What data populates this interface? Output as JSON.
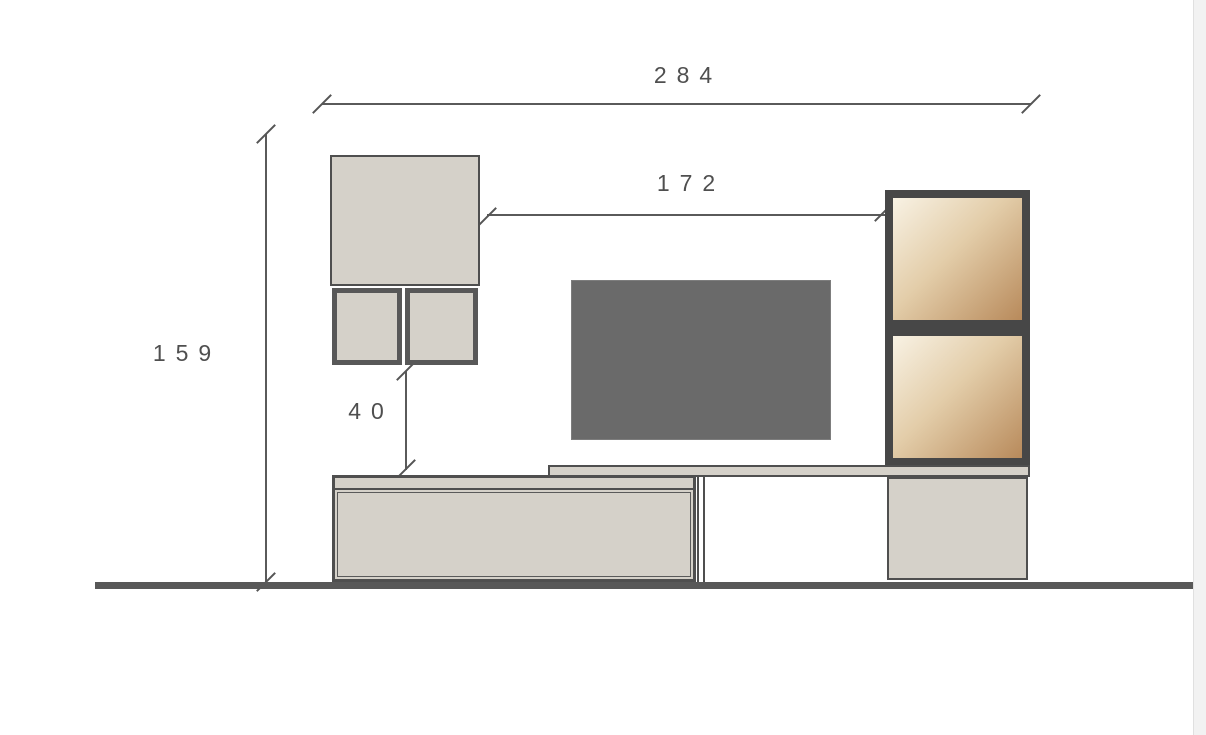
{
  "drawing": {
    "type": "furniture-elevation",
    "dimensions": [
      {
        "name": "overall-width",
        "label": "284",
        "orientation": "horizontal"
      },
      {
        "name": "upper-span",
        "label": "172",
        "orientation": "horizontal"
      },
      {
        "name": "overall-height",
        "label": "159",
        "orientation": "vertical"
      },
      {
        "name": "hang-gap",
        "label": "40",
        "orientation": "vertical"
      }
    ],
    "components": [
      {
        "name": "wall-cabinet"
      },
      {
        "name": "open-box-left"
      },
      {
        "name": "open-box-right"
      },
      {
        "name": "tv-screen"
      },
      {
        "name": "shelf-top"
      },
      {
        "name": "bench-cabinet"
      },
      {
        "name": "side-panel"
      },
      {
        "name": "base-cabinet-right"
      },
      {
        "name": "tall-unit-door-top"
      },
      {
        "name": "tall-unit-door-bottom"
      },
      {
        "name": "floor-line"
      }
    ],
    "colors": {
      "cabinet_fill": "#d5d1c9",
      "outline": "#4f4f4f",
      "tv_fill": "#6a6a6a",
      "floor": "#585858",
      "door_frame": "#474747",
      "door_gradient_light": "#f8f2e4",
      "door_gradient_mid": "#e3cda9",
      "door_gradient_dark": "#b88a5b",
      "dimension_text": "#4f4f4f",
      "page_edge": "#f2f2f2"
    }
  }
}
